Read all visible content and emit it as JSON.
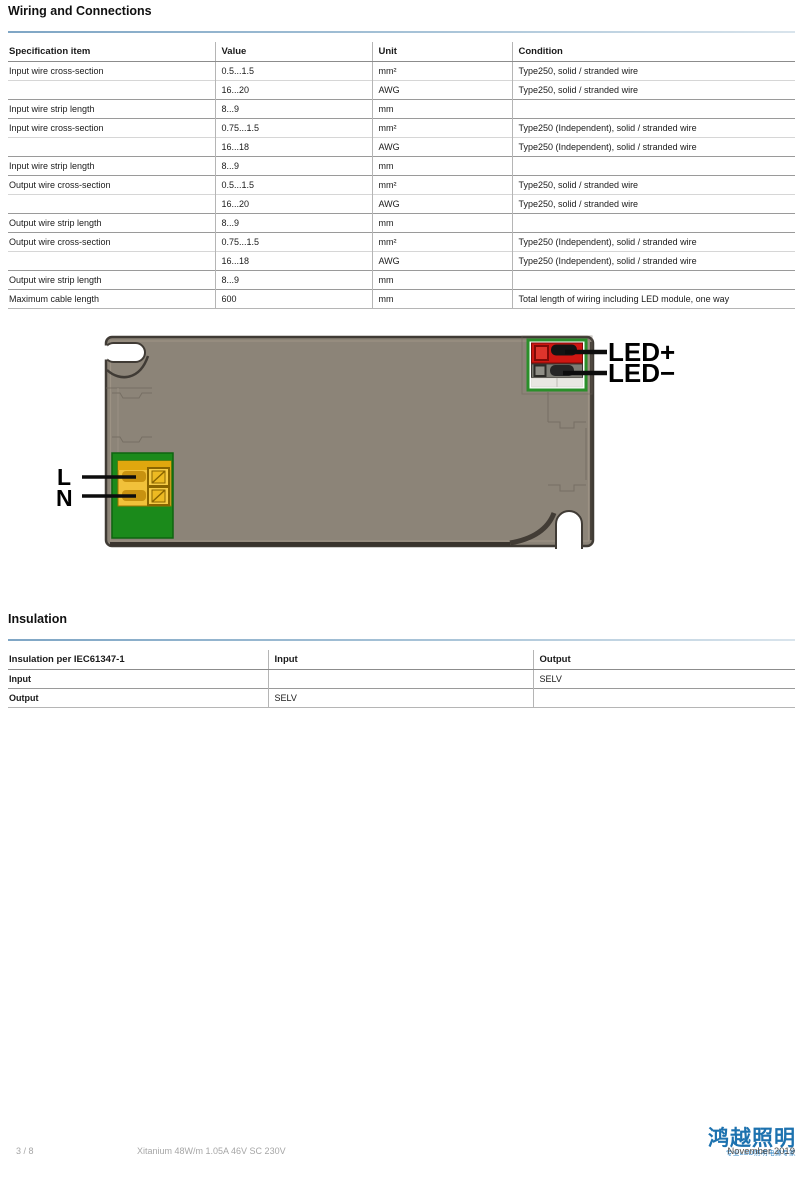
{
  "wiring": {
    "title": "Wiring and Connections",
    "table": {
      "headers": [
        "Specification item",
        "Value",
        "Unit",
        "Condition"
      ],
      "rows": [
        {
          "type": "group",
          "cells": [
            "Input wire cross-section",
            "0.5...1.5",
            "mm²",
            "Type250, solid / stranded wire"
          ]
        },
        {
          "type": "cont",
          "cells": [
            "",
            "16...20",
            "AWG",
            "Type250, solid / stranded wire"
          ]
        },
        {
          "type": "group",
          "cells": [
            "Input wire strip length",
            "8...9",
            "mm",
            ""
          ]
        },
        {
          "type": "group",
          "cells": [
            "Input wire cross-section",
            "0.75...1.5",
            "mm²",
            "Type250 (Independent), solid / stranded wire"
          ]
        },
        {
          "type": "cont",
          "cells": [
            "",
            "16...18",
            "AWG",
            "Type250 (Independent), solid / stranded wire"
          ]
        },
        {
          "type": "group",
          "cells": [
            "Input wire strip length",
            "8...9",
            "mm",
            ""
          ]
        },
        {
          "type": "group",
          "cells": [
            "Output wire cross-section",
            "0.5...1.5",
            "mm²",
            "Type250, solid / stranded wire"
          ]
        },
        {
          "type": "cont",
          "cells": [
            "",
            "16...20",
            "AWG",
            "Type250, solid / stranded wire"
          ]
        },
        {
          "type": "group",
          "cells": [
            "Output wire strip length",
            "8...9",
            "mm",
            ""
          ]
        },
        {
          "type": "group",
          "cells": [
            "Output wire cross-section",
            "0.75...1.5",
            "mm²",
            "Type250 (Independent), solid / stranded wire"
          ]
        },
        {
          "type": "cont",
          "cells": [
            "",
            "16...18",
            "AWG",
            "Type250 (Independent), solid / stranded wire"
          ]
        },
        {
          "type": "group",
          "cells": [
            "Output wire strip length",
            "8...9",
            "mm",
            ""
          ]
        },
        {
          "type": "group",
          "cells": [
            "Maximum cable length",
            "600",
            "mm",
            "Total length of wiring including LED module, one way"
          ]
        }
      ]
    }
  },
  "figure": {
    "labels": {
      "live": "L",
      "neutral": "N",
      "led_plus": "LED+",
      "led_minus": "LED−"
    }
  },
  "insulation": {
    "title": "Insulation",
    "table": {
      "headers": [
        "Insulation per IEC61347-1",
        "Input",
        "Output"
      ],
      "rows": [
        {
          "type": "group",
          "cells": [
            "Input",
            "",
            "SELV"
          ]
        },
        {
          "type": "group",
          "cells": [
            "Output",
            "SELV",
            ""
          ]
        }
      ]
    }
  },
  "footer": {
    "page_number": "3 / 8",
    "product": "Xitanium 48W/m 1.05A 46V SC 230V",
    "date": "November 2019",
    "watermark": {
      "text": "鸿越照明",
      "subtext": "专业LED照明电源专家"
    }
  },
  "colors": {
    "accent_rule": "#7fa6c5",
    "watermark_blue": "#1d72af",
    "driver_body": "#8c8478",
    "pcb_green": "#1b8a1b",
    "terminal_yellow": "#f1c13a",
    "led_plus_red": "#ce1712",
    "led_minus_gray": "#7d7c74"
  }
}
